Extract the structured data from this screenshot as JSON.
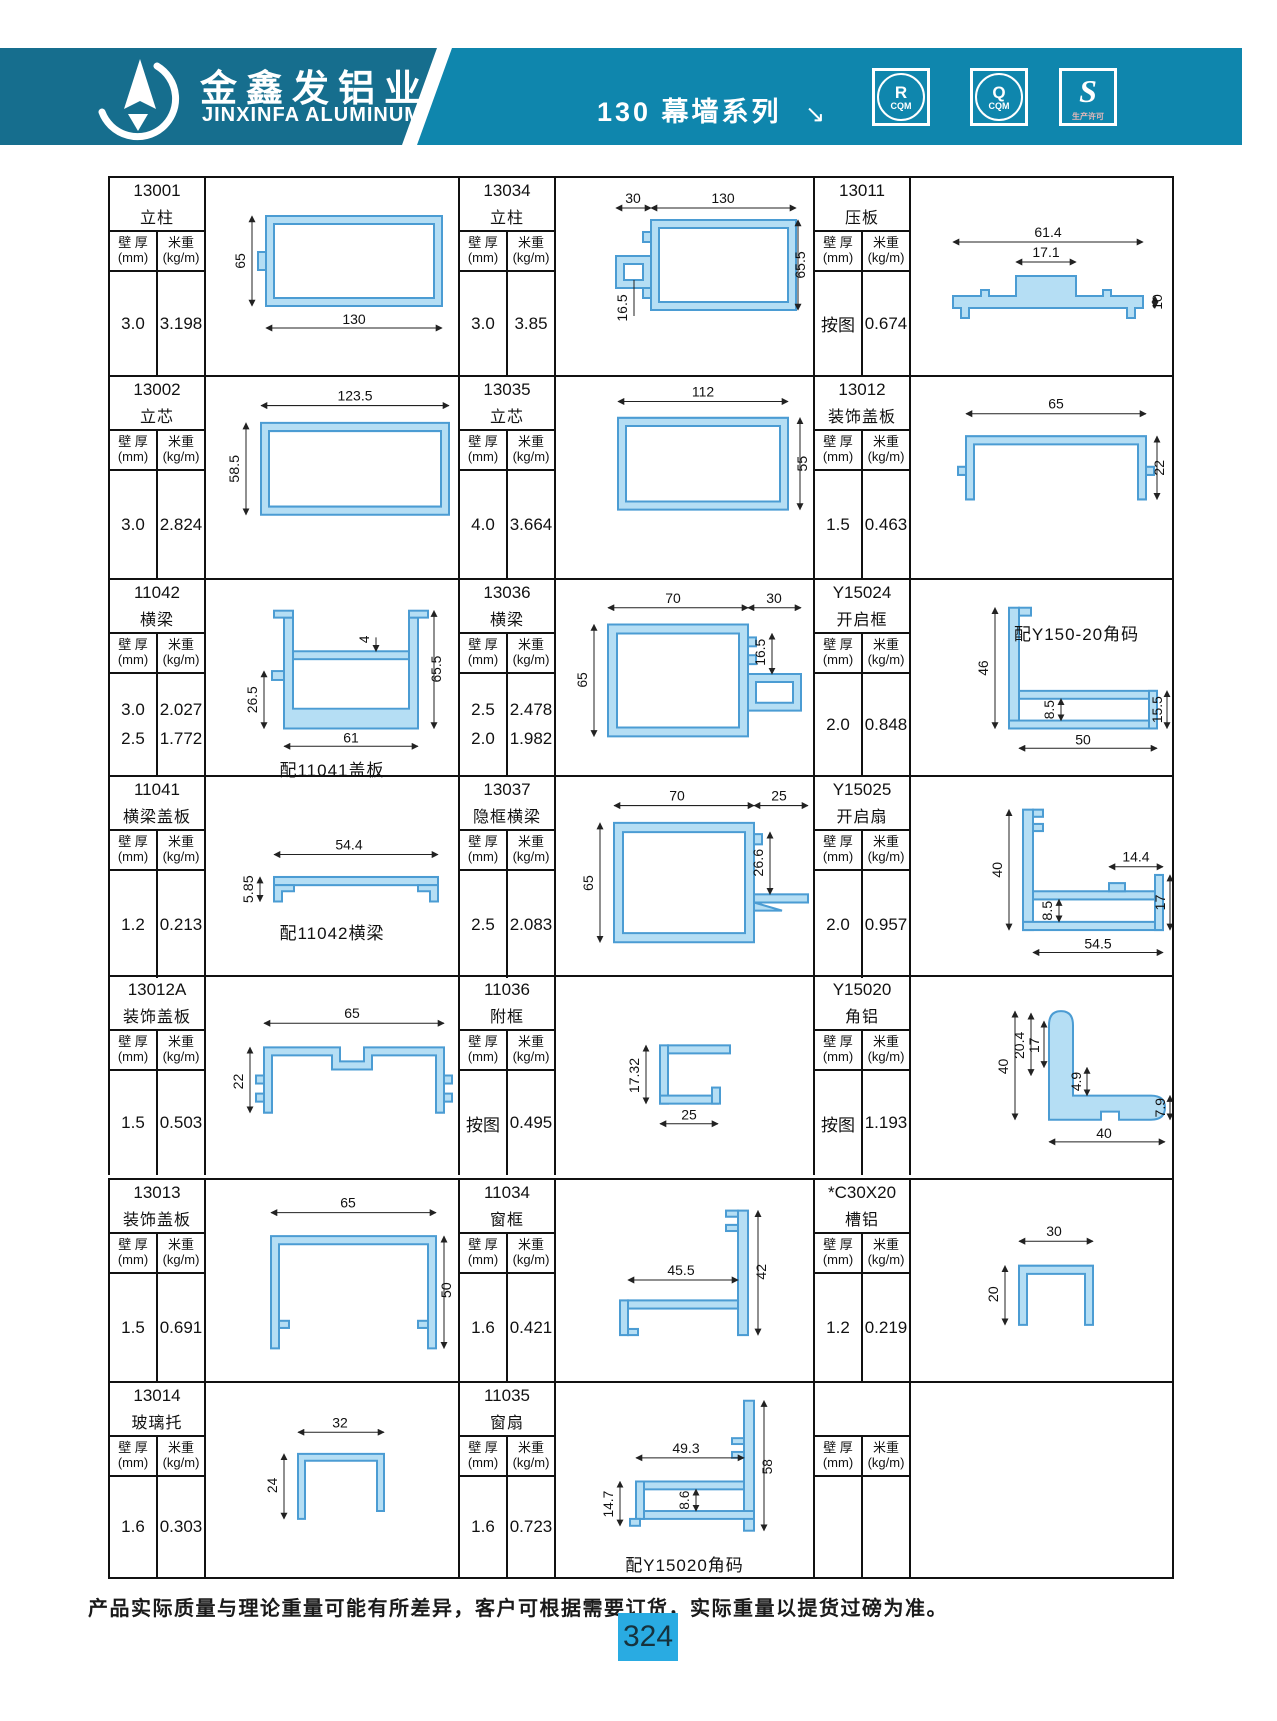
{
  "header": {
    "brand_cn": "金鑫发铝业",
    "brand_en": "JINXINFA ALUMINUM",
    "series_title": "130 幕墙系列",
    "arrow": "↘",
    "badges": [
      {
        "letter": "R",
        "sub": "CQM"
      },
      {
        "letter": "Q",
        "sub": "CQM"
      },
      {
        "letter": "S",
        "sub": "生产许可"
      }
    ]
  },
  "labels": {
    "thickness": "壁 厚",
    "thickness_unit": "(mm)",
    "weight": "米重",
    "weight_unit": "(kg/m)"
  },
  "cells": [
    {
      "code": "13001",
      "name": "立柱",
      "t1": "3.0",
      "w1": "3.198",
      "dims": {
        "a": "65",
        "b": "130"
      }
    },
    {
      "code": "13034",
      "name": "立柱",
      "t1": "3.0",
      "w1": "3.85",
      "dims": {
        "a": "30",
        "b": "130",
        "c": "16.5",
        "d": "65.5"
      }
    },
    {
      "code": "13011",
      "name": "压板",
      "t1": "按图",
      "w1": "0.674",
      "dims": {
        "a": "61.4",
        "b": "17.1",
        "c": "10"
      }
    },
    {
      "code": "13002",
      "name": "立芯",
      "t1": "3.0",
      "w1": "2.824",
      "dims": {
        "a": "123.5",
        "b": "58.5"
      }
    },
    {
      "code": "13035",
      "name": "立芯",
      "t1": "4.0",
      "w1": "3.664",
      "dims": {
        "a": "112",
        "b": "55"
      }
    },
    {
      "code": "13012",
      "name": "装饰盖板",
      "t1": "1.5",
      "w1": "0.463",
      "dims": {
        "a": "65",
        "b": "22"
      }
    },
    {
      "code": "11042",
      "name": "横梁",
      "t1": "3.0",
      "t2": "2.5",
      "w1": "2.027",
      "w2": "1.772",
      "caption": "配11041盖板",
      "dims": {
        "a": "4",
        "b": "65.5",
        "c": "26.5",
        "d": "61"
      }
    },
    {
      "code": "13036",
      "name": "横梁",
      "t1": "2.5",
      "t2": "2.0",
      "w1": "2.478",
      "w2": "1.982",
      "dims": {
        "a": "70",
        "b": "30",
        "c": "16.5",
        "d": "65"
      }
    },
    {
      "code": "Y15024",
      "name": "开启框",
      "t1": "2.0",
      "w1": "0.848",
      "caption": "配Y150-20角码",
      "dims": {
        "a": "46",
        "b": "8.5",
        "c": "15.5",
        "d": "50"
      }
    },
    {
      "code": "11041",
      "name": "横梁盖板",
      "t1": "1.2",
      "w1": "0.213",
      "caption": "配11042横梁",
      "dims": {
        "a": "5.85",
        "b": "54.4"
      }
    },
    {
      "code": "13037",
      "name": "隐框横梁",
      "t1": "2.5",
      "w1": "2.083",
      "dims": {
        "a": "70",
        "b": "25",
        "c": "26.6",
        "d": "65"
      }
    },
    {
      "code": "Y15025",
      "name": "开启扇",
      "t1": "2.0",
      "w1": "0.957",
      "dims": {
        "a": "40",
        "b": "8.5",
        "c": "14.4",
        "d": "17",
        "e": "54.5"
      }
    },
    {
      "code": "13012A",
      "name": "装饰盖板",
      "t1": "1.5",
      "w1": "0.503",
      "dims": {
        "a": "65",
        "b": "22"
      }
    },
    {
      "code": "11036",
      "name": "附框",
      "t1": "按图",
      "w1": "0.495",
      "dims": {
        "a": "17.32",
        "b": "25"
      }
    },
    {
      "code": "Y15020",
      "name": "角铝",
      "t1": "按图",
      "w1": "1.193",
      "dims": {
        "a": "40",
        "b": "20.4",
        "c": "17",
        "d": "4.9",
        "e": "7.9",
        "f": "40"
      }
    },
    {
      "code": "13013",
      "name": "装饰盖板",
      "t1": "1.5",
      "w1": "0.691",
      "dims": {
        "a": "65",
        "b": "50"
      }
    },
    {
      "code": "11034",
      "name": "窗框",
      "t1": "1.6",
      "w1": "0.421",
      "dims": {
        "a": "45.5",
        "b": "42"
      }
    },
    {
      "code": "*C30X20",
      "name": "槽铝",
      "t1": "1.2",
      "w1": "0.219",
      "dims": {
        "a": "30",
        "b": "20"
      }
    },
    {
      "code": "13014",
      "name": "玻璃托",
      "t1": "1.6",
      "w1": "0.303",
      "dims": {
        "a": "32",
        "b": "24"
      }
    },
    {
      "code": "11035",
      "name": "窗扇",
      "t1": "1.6",
      "w1": "0.723",
      "caption": "配Y15020角码",
      "dims": {
        "a": "49.3",
        "b": "58",
        "c": "8.6",
        "d": "14.7"
      }
    },
    {
      "code": "",
      "name": ""
    }
  ],
  "footer": {
    "note": "产品实际质量与理论重量可能有所差异，客户可根据需要订货，实际重量以提货过磅为准。",
    "page": "324"
  }
}
